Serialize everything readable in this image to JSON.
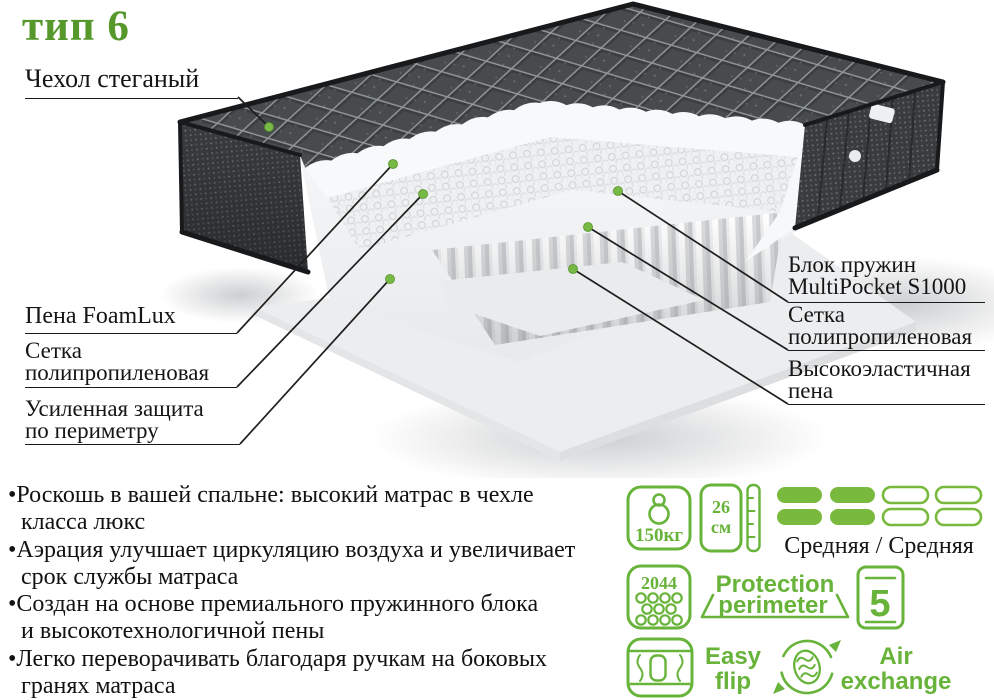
{
  "title": "тип 6",
  "colors": {
    "title_green": "#56982c",
    "icon_green": "#68b33a",
    "pill_fill": "#79ba3e",
    "marker_green": "#78b845",
    "text_black": "#151515",
    "cover_dark": "#474b4e"
  },
  "diagram": {
    "labels": {
      "cover": "Чехол стеганый",
      "foam": "Пена FoamLux",
      "mesh_left_1": "Сетка",
      "mesh_left_2": "полипропиленовая",
      "perimeter_1": "Усиленная защита",
      "perimeter_2": "по периметру",
      "springs_1": "Блок пружин",
      "springs_2": "MultiPocket S1000",
      "mesh_right_1": "Сетка",
      "mesh_right_2": "полипропиленовая",
      "elastic_foam_1": "Высокоэластичная",
      "elastic_foam_2": "пена"
    }
  },
  "features": [
    "•Роскошь в вашей спальне: высокий матрас в чехле\nкласса люкс",
    "•Аэрация улучшает циркуляцию воздуха и увеличивает\nсрок службы матраса",
    "•Создан на основе премиального пружинного блока\nи высокотехнологичной пены",
    "•Легко переворачивать благодаря ручкам на боковых\nгранях матраса"
  ],
  "badges": {
    "max_weight": "150кг",
    "height_value": "26",
    "height_unit": "см",
    "firmness_label": "Средняя / Средняя",
    "springs_count": "2044",
    "warranty_years": "5",
    "protection_line1": "Protection",
    "protection_line2": "perimeter",
    "flip_line1": "Easy",
    "flip_line2": "flip",
    "air_line1": "Air",
    "air_line2": "exchange"
  }
}
